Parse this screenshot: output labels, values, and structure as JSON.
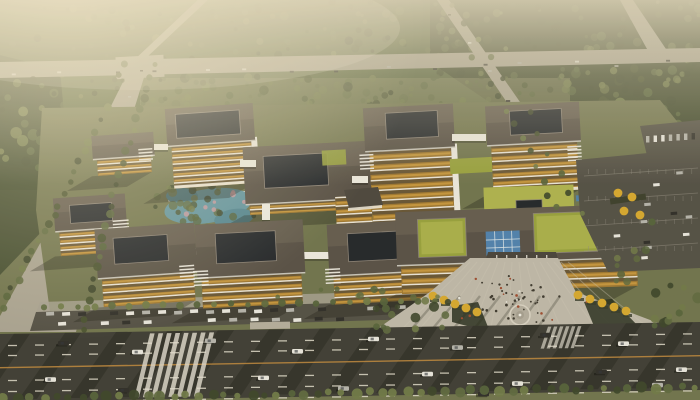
{
  "image": {
    "type": "aerial-architectural-rendering",
    "subject": "modern campus of white and amber office/hospital buildings with dark flat roofs, courtyard skylights and green roofs, landscaped ponds, entrance plaza with pedestrians, surrounded by forest, highways and parking lots",
    "atmosphere": "warm hazy daylight, strong atmospheric fade toward horizon"
  },
  "scene": {
    "buildings": [
      "left-small-block",
      "left-courtyard-tower",
      "center-podium-block",
      "center-tower",
      "right-tower",
      "left-bottom-block",
      "left-bottom-courtyard-block",
      "bottom-courtyard-block-west",
      "bottom-courtyard-block-east",
      "right-long-complex-with-green-courtyards",
      "garden-pavilion"
    ],
    "landscape": [
      "central-pond-garden",
      "east-pond",
      "stream",
      "green-roof-terraces",
      "blue-solar-skylight",
      "entrance-plaza-with-fountain",
      "yellow-autumn-trees",
      "street-tree-rows",
      "forest-belt"
    ],
    "infrastructure": [
      "top-highway-intersection",
      "left-diagonal-avenue",
      "right-diagonal-road",
      "bottom-main-road",
      "zebra-crosswalk",
      "surface-parking-east",
      "street-parking-rows",
      "entrance-canopy-with-red-signs"
    ]
  },
  "palette": {
    "haze": "#d9d0b7",
    "sun_glow": "#fff3d4",
    "warm_tint": "#c9a96a",
    "forest_dark": "#3a432a",
    "forest_mid": "#53603a",
    "forest_light": "#6e7848",
    "park_green": "#6e724d",
    "lawn_pale": "#7c7d58",
    "road_light": "#a8a292",
    "asphalt": "#3d3c35",
    "lane_marking": "#ded9cb",
    "center_line": "#b8843c",
    "parking_asphalt": "#514e45",
    "roof_dark": "#564f46",
    "roof_lit": "#7e7466",
    "fascia_white": "#ece9e1",
    "wall_white": "#eae7df",
    "wall_shade": "#c2bfb5",
    "facade_amber": "#c9902f",
    "facade_amber_bright": "#e2ad49",
    "window_dark": "#2e3239",
    "skylight_dark": "#20242a",
    "green_roof": "#96a03d",
    "green_roof_light": "#adb24e",
    "solar_blue": "#4d80ae",
    "water": "#5f93a0",
    "water_deep": "#4f8391",
    "plaza": "#bdb7a9",
    "plaza_light": "#cac4b5",
    "autumn_tree": "#d5a72f",
    "blossom_pink": "#c998a0",
    "canopy_dark": "#46423b",
    "accent_red": "#b03527",
    "car_white": "#e7e5de",
    "car_silver": "#b4b3ac",
    "car_dark": "#2d2c29",
    "people_dark": "#3b372f",
    "people_warm": "#9c4a30",
    "shadow": "rgba(24,26,18,0.32)"
  }
}
